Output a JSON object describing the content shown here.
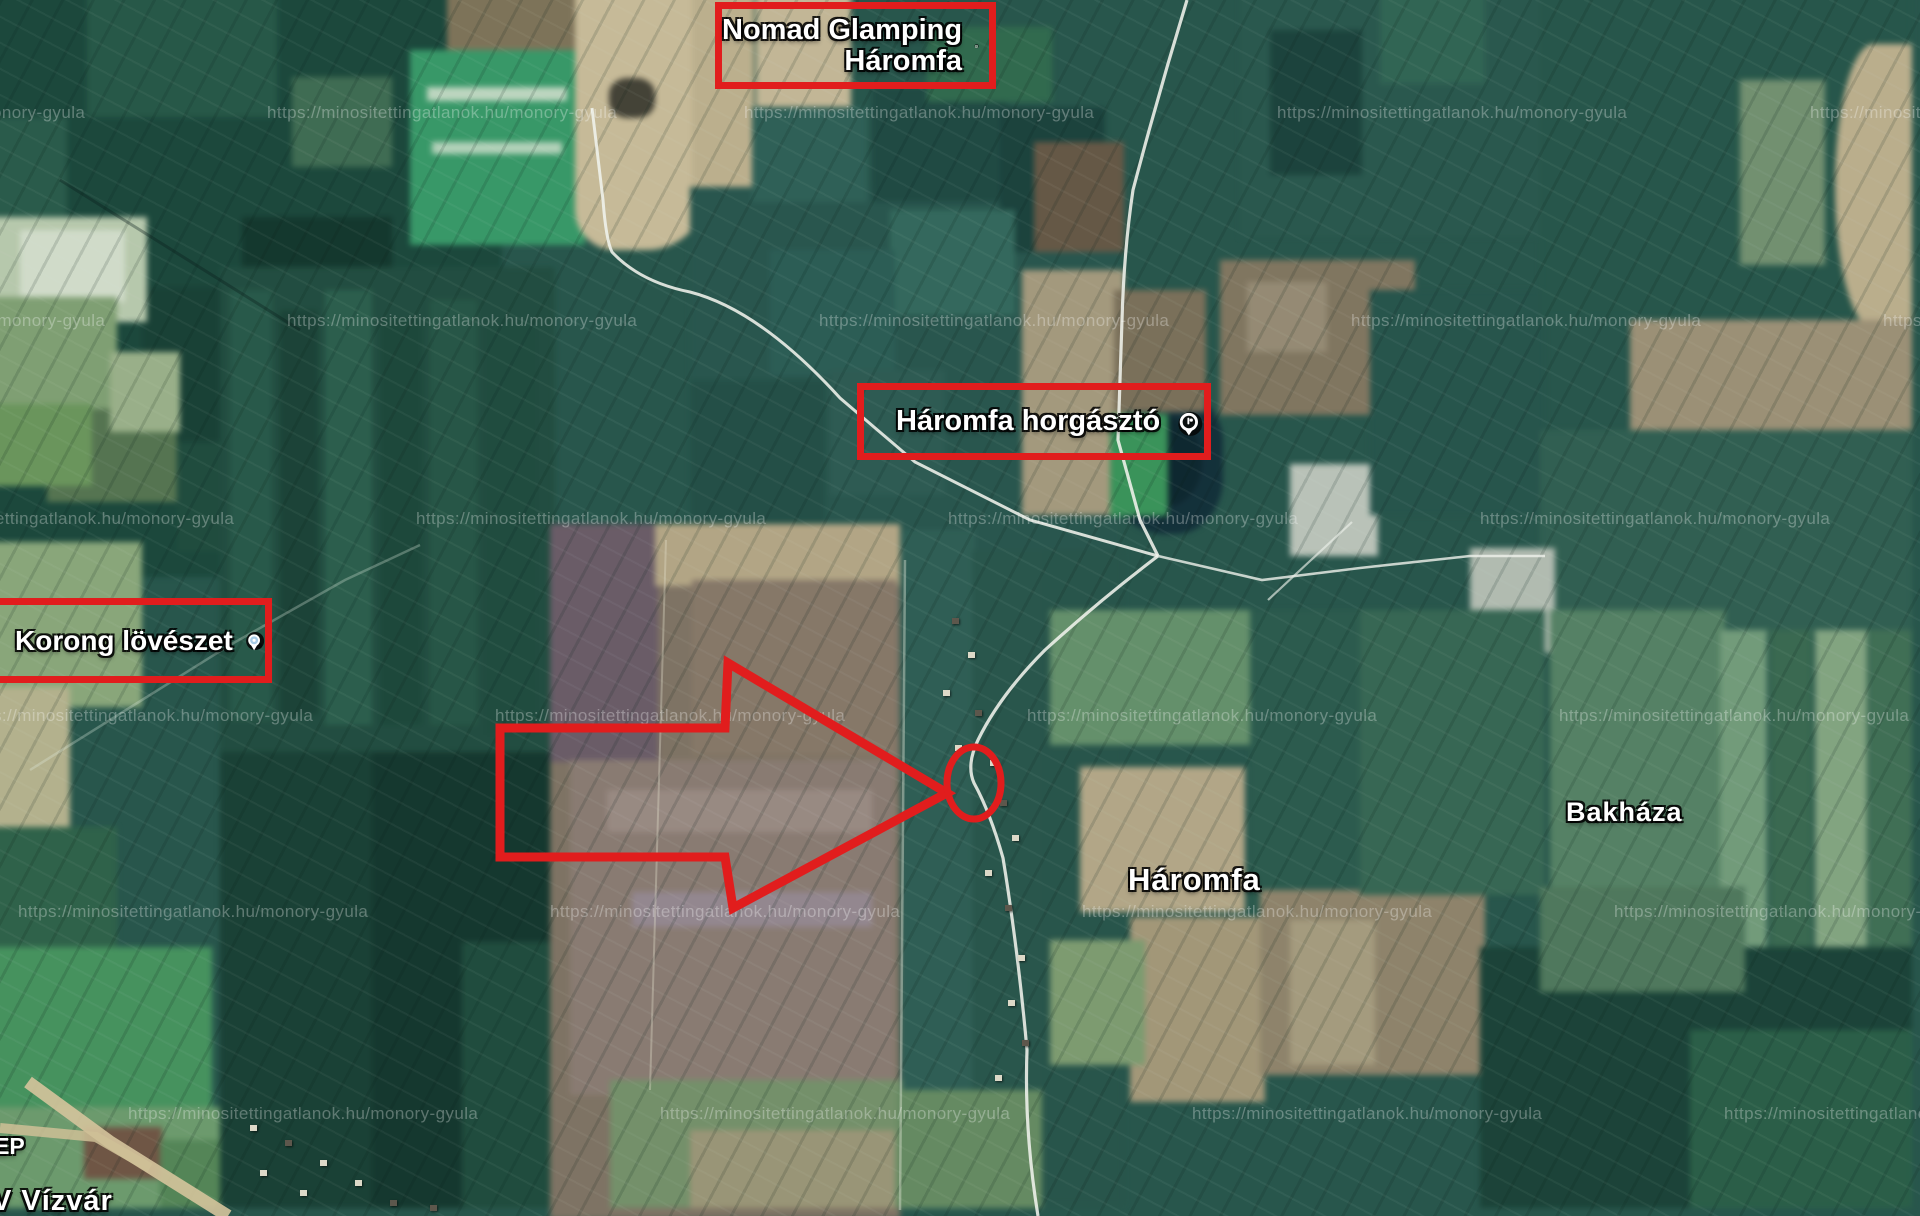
{
  "map": {
    "type": "satellite-imagery",
    "accent_red": "#e11d1d",
    "annotations": {
      "nomad": {
        "line1": "Nomad Glamping",
        "line2": "Háromfa",
        "icon": "glamping-pin-icon"
      },
      "horgaszto": {
        "label": "Háromfa horgásztó",
        "icon": "fishing-pin-icon"
      },
      "korong": {
        "label": "Korong lövészet",
        "icon": "shooting-pin-icon"
      }
    },
    "places": {
      "haromfa": "Háromfa",
      "bakhaza": "Bakháza",
      "vizvar": "V Vízvár",
      "ep_fragment": "EP"
    },
    "watermark": {
      "text": "https://minositettingatlanok.hu/monory-gyula"
    }
  }
}
